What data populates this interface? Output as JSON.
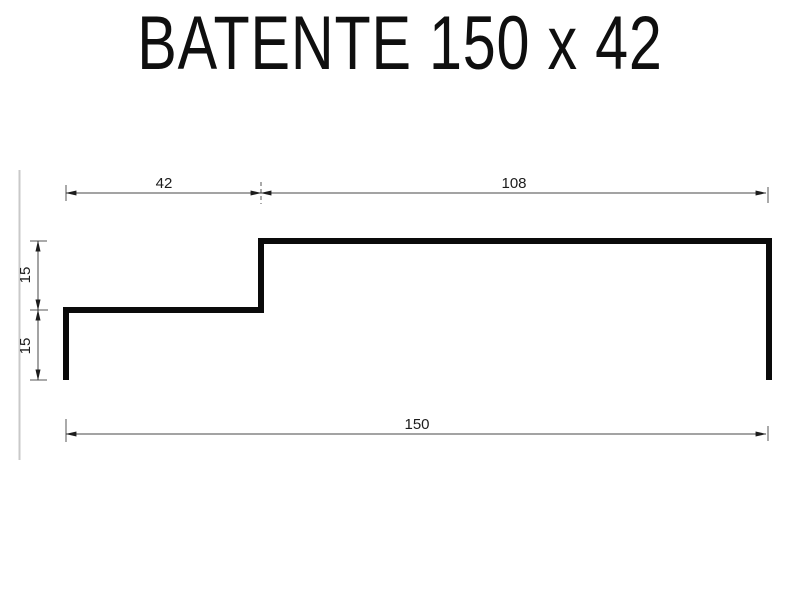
{
  "title": "BATENTE 150 x 42",
  "drawing": {
    "dimensions": {
      "top_step_width": "42",
      "top_main_width": "108",
      "left_upper_height": "15",
      "left_lower_height": "15",
      "total_width": "150"
    },
    "colors": {
      "profile": "#0a0a0a",
      "dimension_line": "#474747",
      "extension_tick": "#555555",
      "dimension_text": "#1c1c1c",
      "page_edge": "#c9c9c9",
      "background": "#ffffff"
    }
  }
}
